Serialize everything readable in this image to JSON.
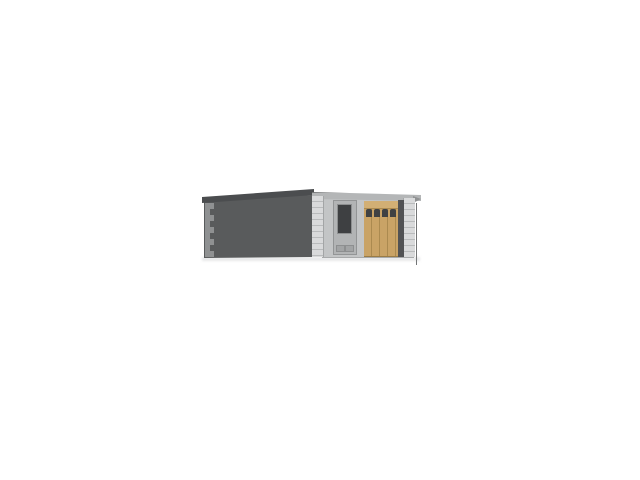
{
  "meta": {
    "description": "3D architectural rendering of a small flat-roof garage building viewed from the front-left corner on a plain white background",
    "background": "#ffffff"
  },
  "scene": {
    "building": {
      "label": "flat-roof garage with entry door and wooden garage door",
      "side_wall": {
        "label": "shaded left side wall with corner quoin blocks",
        "color": "#595b5c",
        "roof_color": "#4b4d4f",
        "quoin_color": "#8f9192"
      },
      "facade": {
        "label": "lit front facade with quoined corners and roof fascia",
        "color": "#c3c5c6",
        "fascia_color": "#b4b6b7",
        "fascia_edge_color": "#747677",
        "quoin_light": "#d9dadb",
        "quoin_dark": "#b9bbbc"
      },
      "entry_door": {
        "label": "pedestrian door with tall dark glass panel and two lower vents",
        "face_color": "#b2b4b5",
        "frame_color": "#939596",
        "window_color": "#3e4042"
      },
      "garage_door": {
        "label": "tan wooden sectional garage door with a row of small windows",
        "color": "#c9a366",
        "seam_color": "#ab8a50",
        "top_rail_color": "#d2af74",
        "window_color": "#3f4143",
        "window_count": 4
      },
      "door_gap_color": "#515254",
      "shadow_color": "#e8e9ea"
    }
  }
}
